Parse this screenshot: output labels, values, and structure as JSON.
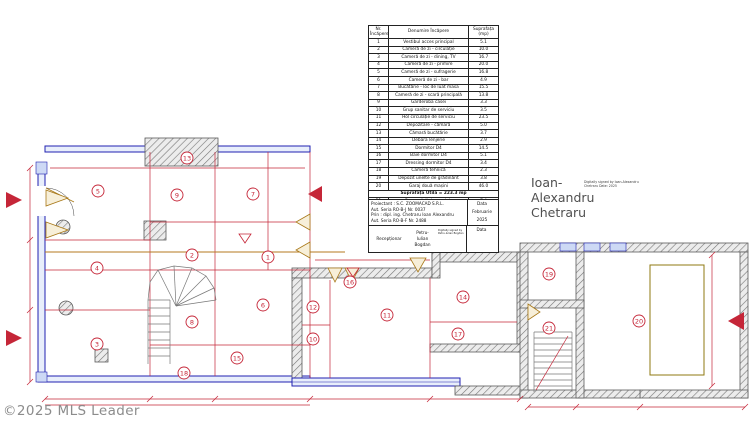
{
  "watermark": {
    "text": "©2025 MLS Leader"
  },
  "room_table": {
    "headers": [
      "Nr. Încăpere",
      "Denumire Încăpere",
      "Suprafața (mp)"
    ],
    "rows": [
      [
        "1",
        "Vestibul acces principal",
        "5.1"
      ],
      [
        "2",
        "Cameră de zi - circulație",
        "10.0"
      ],
      [
        "3",
        "Cameră de zi - dining, TV",
        "16.7"
      ],
      [
        "4",
        "Cameră de zi - primire",
        "20.0"
      ],
      [
        "5",
        "Cameră de zi - sufragerie",
        "16.8"
      ],
      [
        "6",
        "Cameră de zi - bar",
        "4.9"
      ],
      [
        "7",
        "Bucătărie - loc de luat masa",
        "15.5"
      ],
      [
        "8",
        "Cameră de zi - scară principală",
        "13.8"
      ],
      [
        "9",
        "Garderoba casei",
        "3.3"
      ],
      [
        "10",
        "Grup sanitar de serviciu",
        "3.5"
      ],
      [
        "11",
        "Hol circulație de serviciu",
        "23.5"
      ],
      [
        "12",
        "Depozitare - cămară",
        "5.0"
      ],
      [
        "13",
        "Cămară bucătărie",
        "3.7"
      ],
      [
        "14",
        "Debara lenjerie",
        "2.9"
      ],
      [
        "15",
        "Dormitor D4",
        "14.5"
      ],
      [
        "16",
        "Baie dormitor D4",
        "5.1"
      ],
      [
        "17",
        "Dressing dormitor D4",
        "3.4"
      ],
      [
        "18",
        "Cameră tehnică",
        "2.3"
      ],
      [
        "19",
        "Depozit unelte de grădinărit",
        "3.8"
      ],
      [
        "20",
        "Garaj două mașini",
        "46.0"
      ]
    ],
    "subtotal": "Suprafața Utilă = 223.3 mp",
    "row_21": [
      "21",
      "Casa scării de serviciu",
      "7.4"
    ],
    "total": "Suprafața Totală = 230.7 mp"
  },
  "title_block": {
    "proiectant_lines": [
      "Proiectant : S.C. ZOOMACAD S.R.L.",
      "Aut. Seria RO-B-J Nr. 0037",
      "Prin : dipl. ing. Chetraru Ioan Alexandru",
      "Aut. Seria RO-B-F Nr. 2488"
    ],
    "data_label": "Data",
    "data_month": "Februarie",
    "data_year": "2025",
    "receptionar_label": "Recepționar",
    "receptionar_name": "Petru-Iulian Bogdan",
    "receptionar_sign_note": "Digitally signed by Petru-Iulian Bogdan",
    "data_label2": "Data"
  },
  "signature": {
    "name": "Ioan-Alexandru Chetraru",
    "details": "Digitally signed by Ioan-Alexandru Chetraru Date: 2025"
  },
  "plan": {
    "colors": {
      "wall_blue": "#2020b0",
      "cad_red": "#c52638",
      "door_olive": "#a87818",
      "hatch_gray": "#8a8a8a"
    },
    "room_markers": [
      {
        "n": "1",
        "x": 268,
        "y": 257
      },
      {
        "n": "2",
        "x": 192,
        "y": 255
      },
      {
        "n": "3",
        "x": 97,
        "y": 344
      },
      {
        "n": "4",
        "x": 97,
        "y": 268
      },
      {
        "n": "5",
        "x": 98,
        "y": 191
      },
      {
        "n": "6",
        "x": 263,
        "y": 305
      },
      {
        "n": "7",
        "x": 253,
        "y": 194
      },
      {
        "n": "8",
        "x": 192,
        "y": 322
      },
      {
        "n": "9",
        "x": 177,
        "y": 195
      },
      {
        "n": "10",
        "x": 313,
        "y": 339
      },
      {
        "n": "11",
        "x": 387,
        "y": 315
      },
      {
        "n": "12",
        "x": 313,
        "y": 307
      },
      {
        "n": "13",
        "x": 187,
        "y": 158
      },
      {
        "n": "14",
        "x": 463,
        "y": 297
      },
      {
        "n": "15",
        "x": 237,
        "y": 358
      },
      {
        "n": "16",
        "x": 350,
        "y": 282
      },
      {
        "n": "17",
        "x": 458,
        "y": 334
      },
      {
        "n": "18",
        "x": 184,
        "y": 373
      },
      {
        "n": "19",
        "x": 549,
        "y": 274
      },
      {
        "n": "20",
        "x": 639,
        "y": 321
      },
      {
        "n": "21",
        "x": 549,
        "y": 328
      }
    ]
  }
}
